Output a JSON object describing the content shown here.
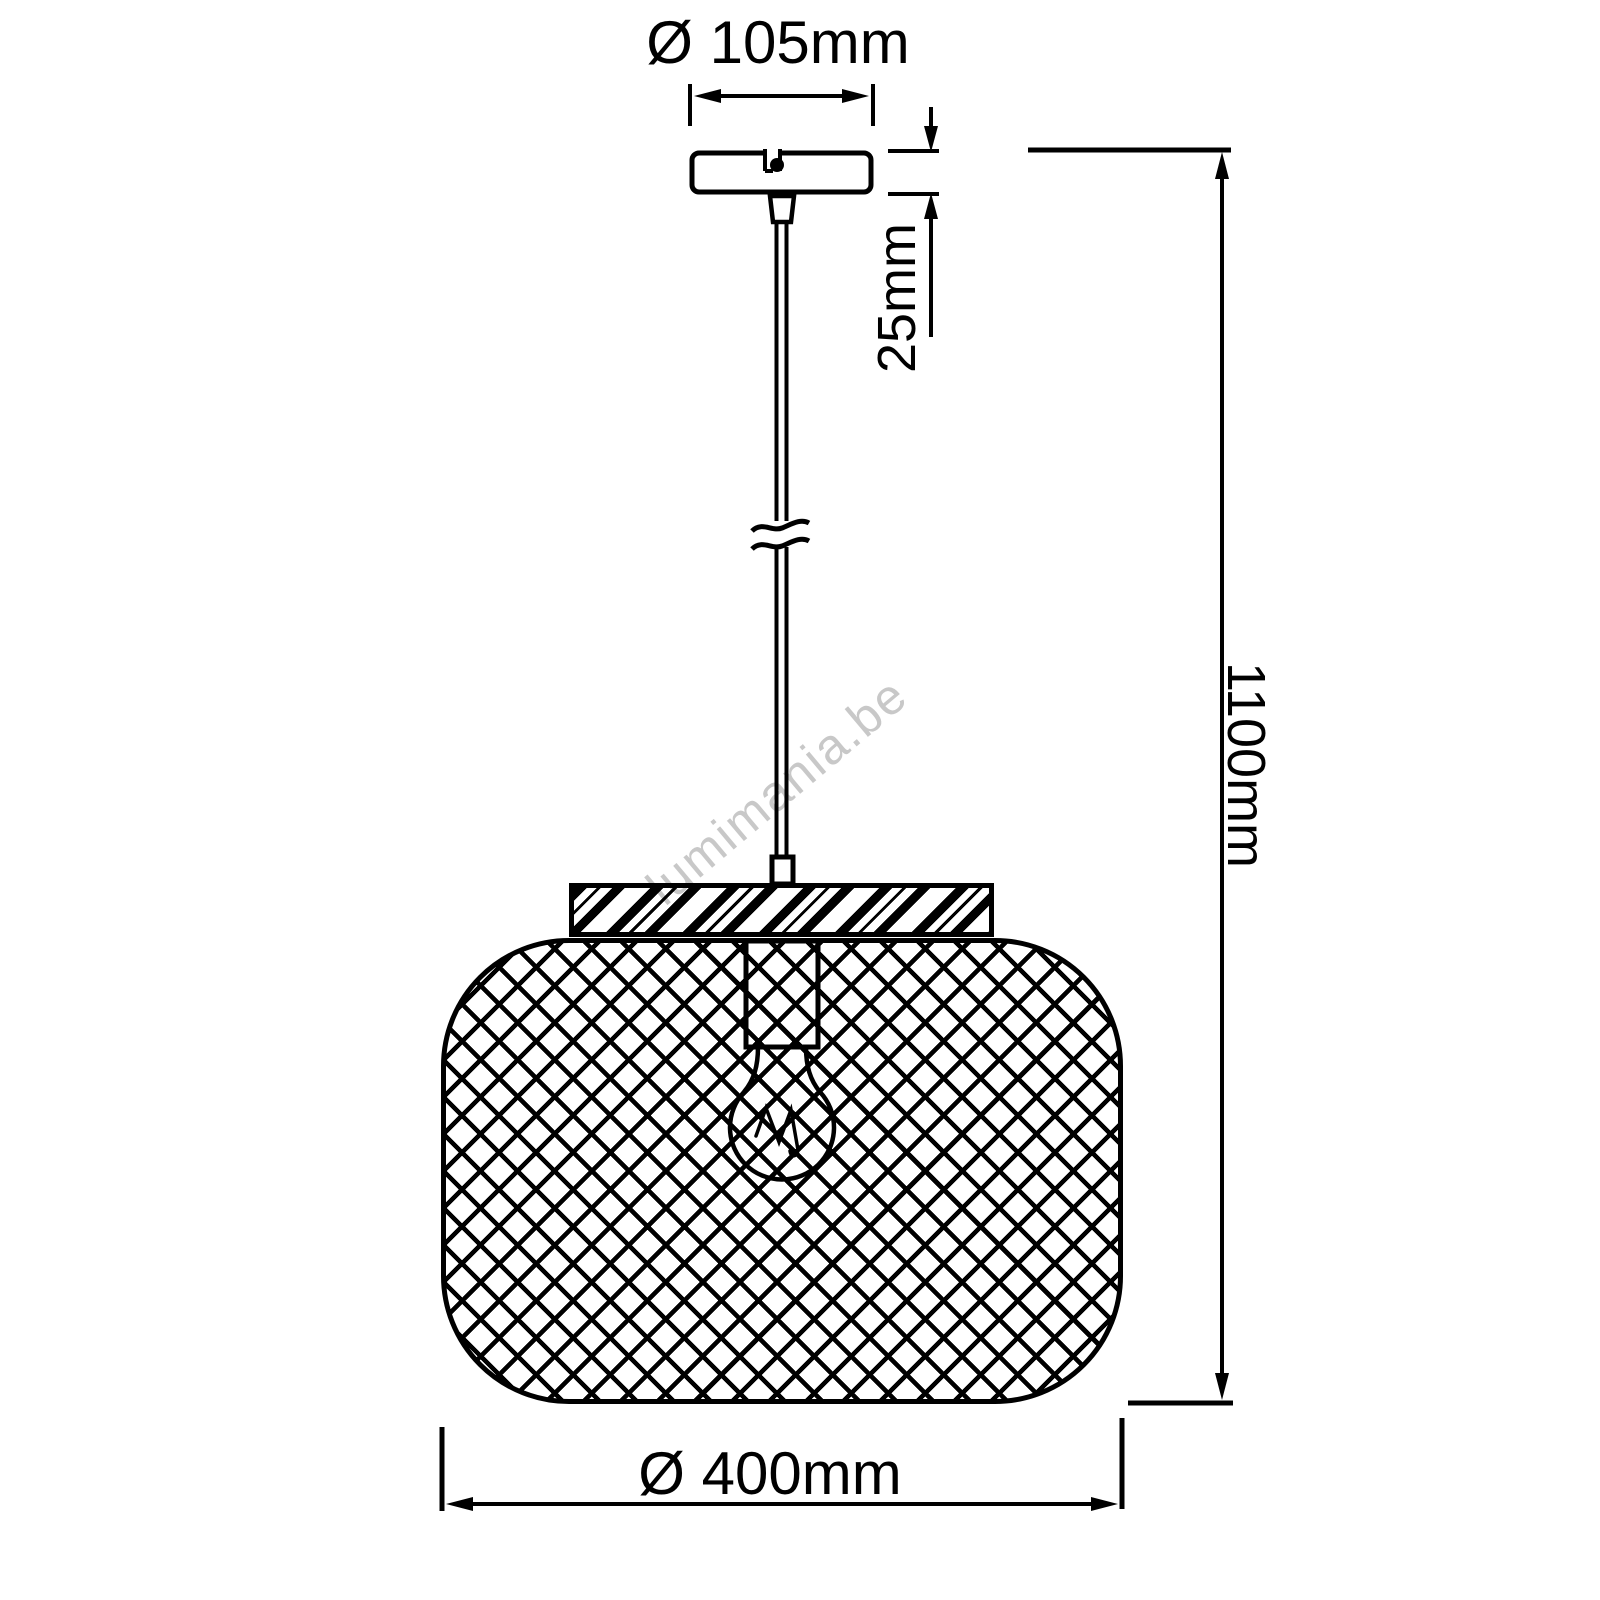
{
  "dims": {
    "canopy_diameter": "Ø 105mm",
    "canopy_height": "25mm",
    "total_height": "1100mm",
    "shade_diameter": "Ø 400mm"
  },
  "watermark": "lumimania.be",
  "colors": {
    "line": "#000000",
    "background": "#ffffff",
    "watermark": "#c8c8c8"
  }
}
